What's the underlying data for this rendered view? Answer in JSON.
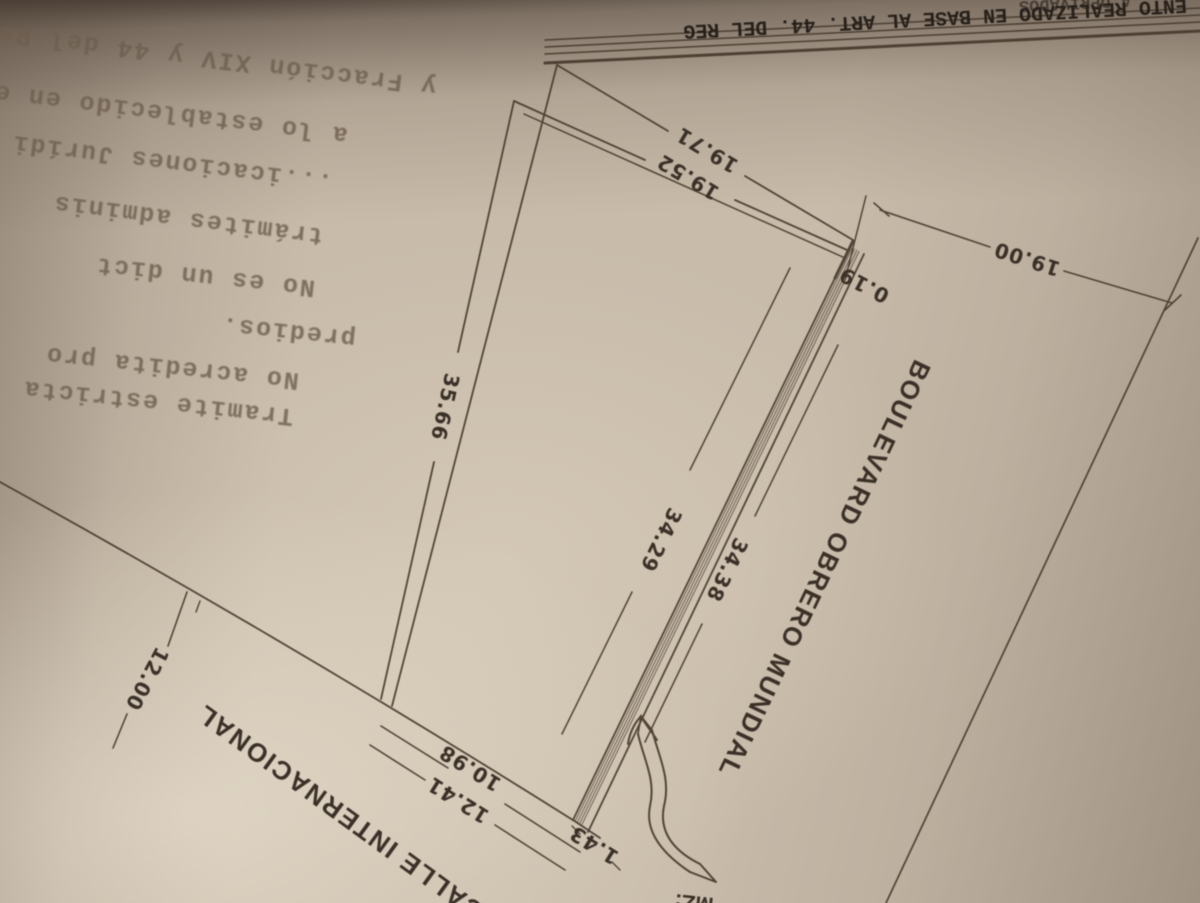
{
  "photo": {
    "description": "Photograph of a typed cadastral survey plan, page rotated 180 degrees",
    "paper_color": "#c8bbaa",
    "ink_color": "#463a2d"
  },
  "header": {
    "clipped_line": "A DERIVADOS",
    "legend_line": "ENTO REALIZADO EN BASE AL ART. 44. DEL REG"
  },
  "typed_block": {
    "lines": [
      "y Fracción XIV y 44 del Regl",
      "a lo establecido en el",
      "...icaciones Jurídi",
      "trámites adminis",
      "No es un dict",
      "predios.",
      "No acredita pro",
      "Tramite estricta"
    ]
  },
  "plan": {
    "streets": {
      "boulevard": "BOULEVARD OBRERO MUNDIAL",
      "calle": "CALLE INTERNACIONAL"
    },
    "block_fragment": "MZ:",
    "dimensions": {
      "top_outer": "19.71",
      "top_inner": "19.52",
      "corner_jog": "0.19",
      "boulevard_width": "19.00",
      "left_side": "35.66",
      "right_inner": "34.29",
      "right_outer": "34.38",
      "calle_width": "12.00",
      "bottom_inner": "10.98",
      "bottom_outer": "12.41",
      "bottom_jog": "1.43"
    }
  }
}
